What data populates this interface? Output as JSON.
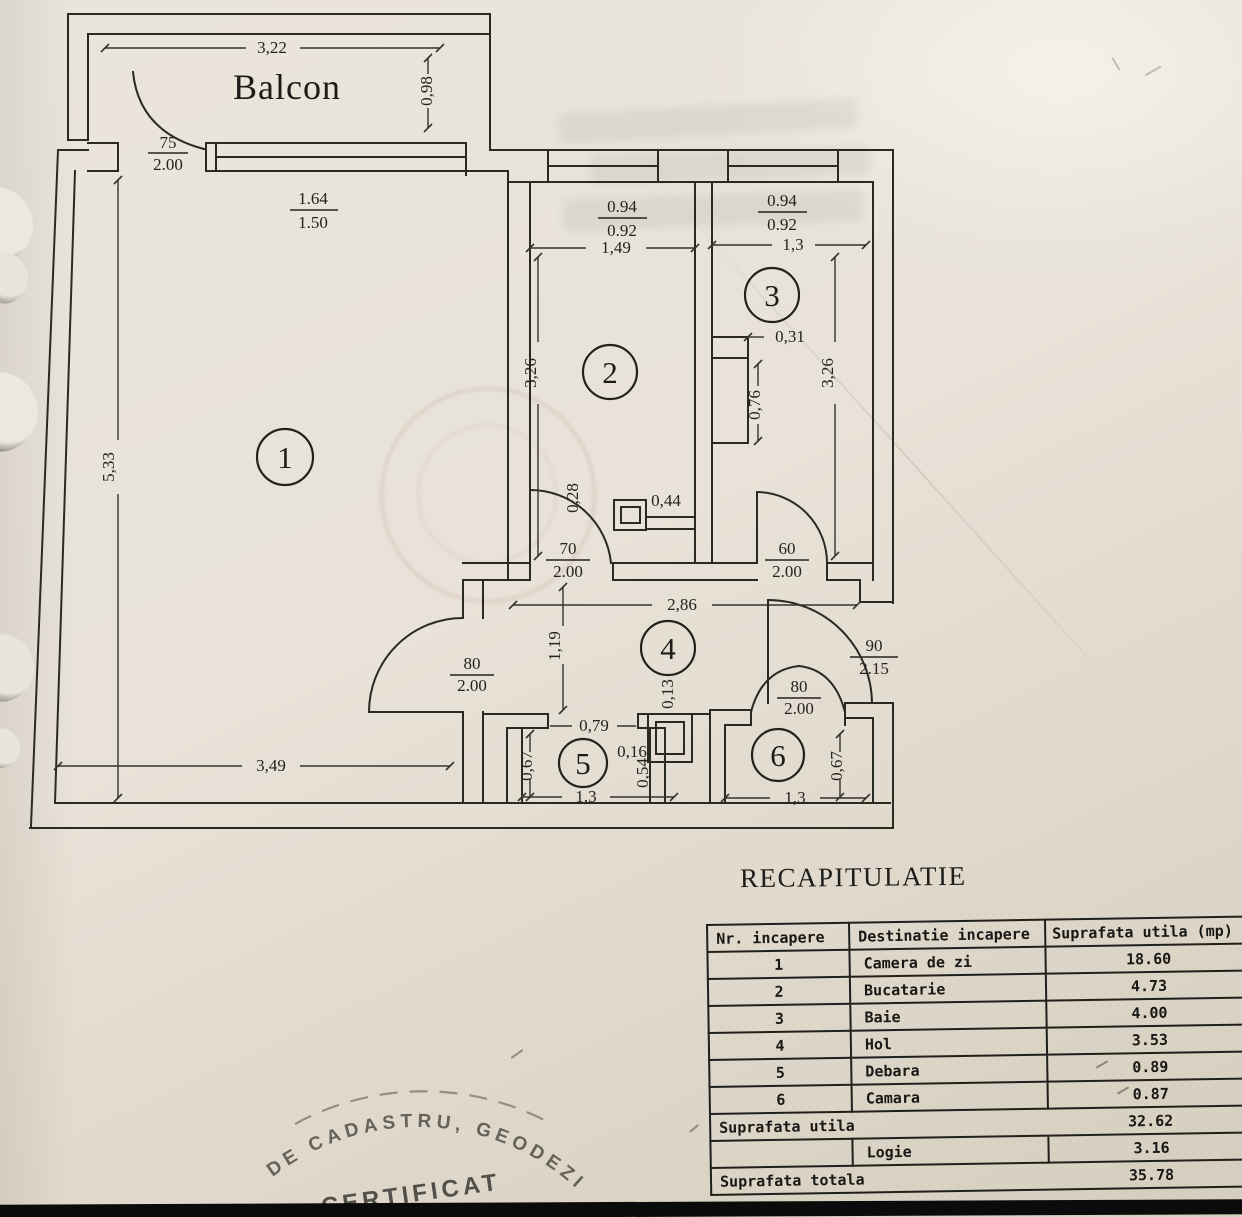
{
  "plan": {
    "balcony_label": "Balcon",
    "rooms": [
      "1",
      "2",
      "3",
      "4",
      "5",
      "6"
    ],
    "dims": {
      "balcony_width": "3,22",
      "balcony_depth": "0,98",
      "room1_window_top": "1.64",
      "room1_window_bottom": "1.50",
      "room1_depth": "5,33",
      "room1_width": "3,49",
      "kitchen_window_top": "0.94",
      "kitchen_window_bottom": "0.92",
      "kitchen_width": "1,49",
      "kitchen_depth": "3,26",
      "bath_window_top": "0.94",
      "bath_window_bottom": "0.92",
      "bath_width": "1,3",
      "bath_depth": "3,26",
      "duct_width": "0,31",
      "duct_height": "0,76",
      "flue_offset_v": "0,28",
      "flue_offset_h": "0,44",
      "hall_width": "2,86",
      "hall_depth": "1,19",
      "hall_step": "0,13",
      "room5_door_width": "0,79",
      "shaft_width": "0,16",
      "shaft_height": "0,54",
      "room5_depth": "0,67",
      "room5_width": "1,3",
      "room6_depth": "0,67",
      "room6_width": "1,3"
    },
    "doors": {
      "balcony": {
        "w": "75",
        "h": "2.00"
      },
      "kitchen": {
        "w": "70",
        "h": "2.00"
      },
      "bath": {
        "w": "60",
        "h": "2.00"
      },
      "living": {
        "w": "80",
        "h": "2.00"
      },
      "camara": {
        "w": "80",
        "h": "2.00"
      },
      "entry": {
        "w": "90",
        "h": "2.15"
      }
    }
  },
  "recap": {
    "title": "RECAPITULATIE",
    "table": {
      "headers": [
        "Nr. incapere",
        "Destinatie incapere",
        "Suprafata utila (mp)"
      ],
      "rows": [
        {
          "nr": "1",
          "dest": "Camera de zi",
          "area": "18.60"
        },
        {
          "nr": "2",
          "dest": "Bucatarie",
          "area": "4.73"
        },
        {
          "nr": "3",
          "dest": "Baie",
          "area": "4.00"
        },
        {
          "nr": "4",
          "dest": "Hol",
          "area": "3.53"
        },
        {
          "nr": "5",
          "dest": "Debara",
          "area": "0.89"
        },
        {
          "nr": "6",
          "dest": "Camara",
          "area": "0.87"
        }
      ],
      "subtotal_label": "Suprafata utila",
      "subtotal_value": "32.62",
      "logie_label": "Logie",
      "logie_value": "3.16",
      "total_label": "Suprafata totala",
      "total_value": "35.78"
    }
  },
  "stamp": {
    "arc_text": "DE CADASTRU, GEODEZIE S",
    "name_text": "CERTIFICAT"
  }
}
